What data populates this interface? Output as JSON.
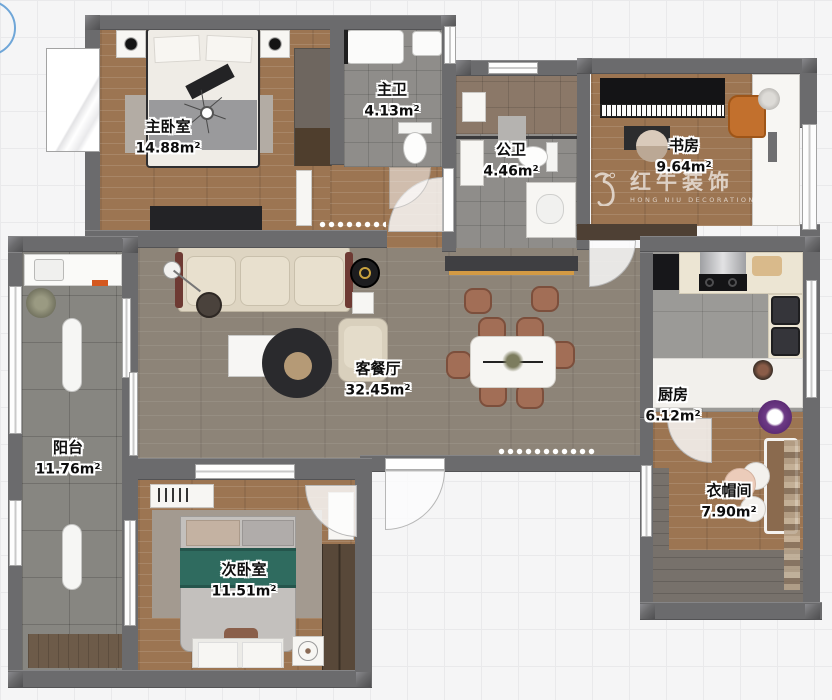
{
  "watermark": {
    "brand": "红牛装饰",
    "subtitle": "HONG NIU DECORATION"
  },
  "rooms": [
    {
      "id": "master-bedroom",
      "name": "主卧室",
      "area": "14.88m²"
    },
    {
      "id": "master-bath",
      "name": "主卫",
      "area": "4.13m²"
    },
    {
      "id": "public-bath",
      "name": "公卫",
      "area": "4.46m²"
    },
    {
      "id": "study",
      "name": "书房",
      "area": "9.64m²"
    },
    {
      "id": "living-dining",
      "name": "客餐厅",
      "area": "32.45m²"
    },
    {
      "id": "kitchen",
      "name": "厨房",
      "area": "6.12m²"
    },
    {
      "id": "balcony",
      "name": "阳台",
      "area": "11.76m²"
    },
    {
      "id": "second-bedroom",
      "name": "次卧室",
      "area": "11.51m²"
    },
    {
      "id": "cloakroom",
      "name": "衣帽间",
      "area": "7.90m²"
    }
  ],
  "palette": {
    "wall": "#6b6b6d",
    "wood_floor": "#9c7552",
    "living_floor": "#8d8478",
    "accent_orange": "#d39a44",
    "teal_blanket": "#2f6b5f",
    "chair_brown": "#a26e56",
    "compass_blue": "#6fa6d8",
    "watermark_white": "rgba(255,255,255,0.66)"
  }
}
